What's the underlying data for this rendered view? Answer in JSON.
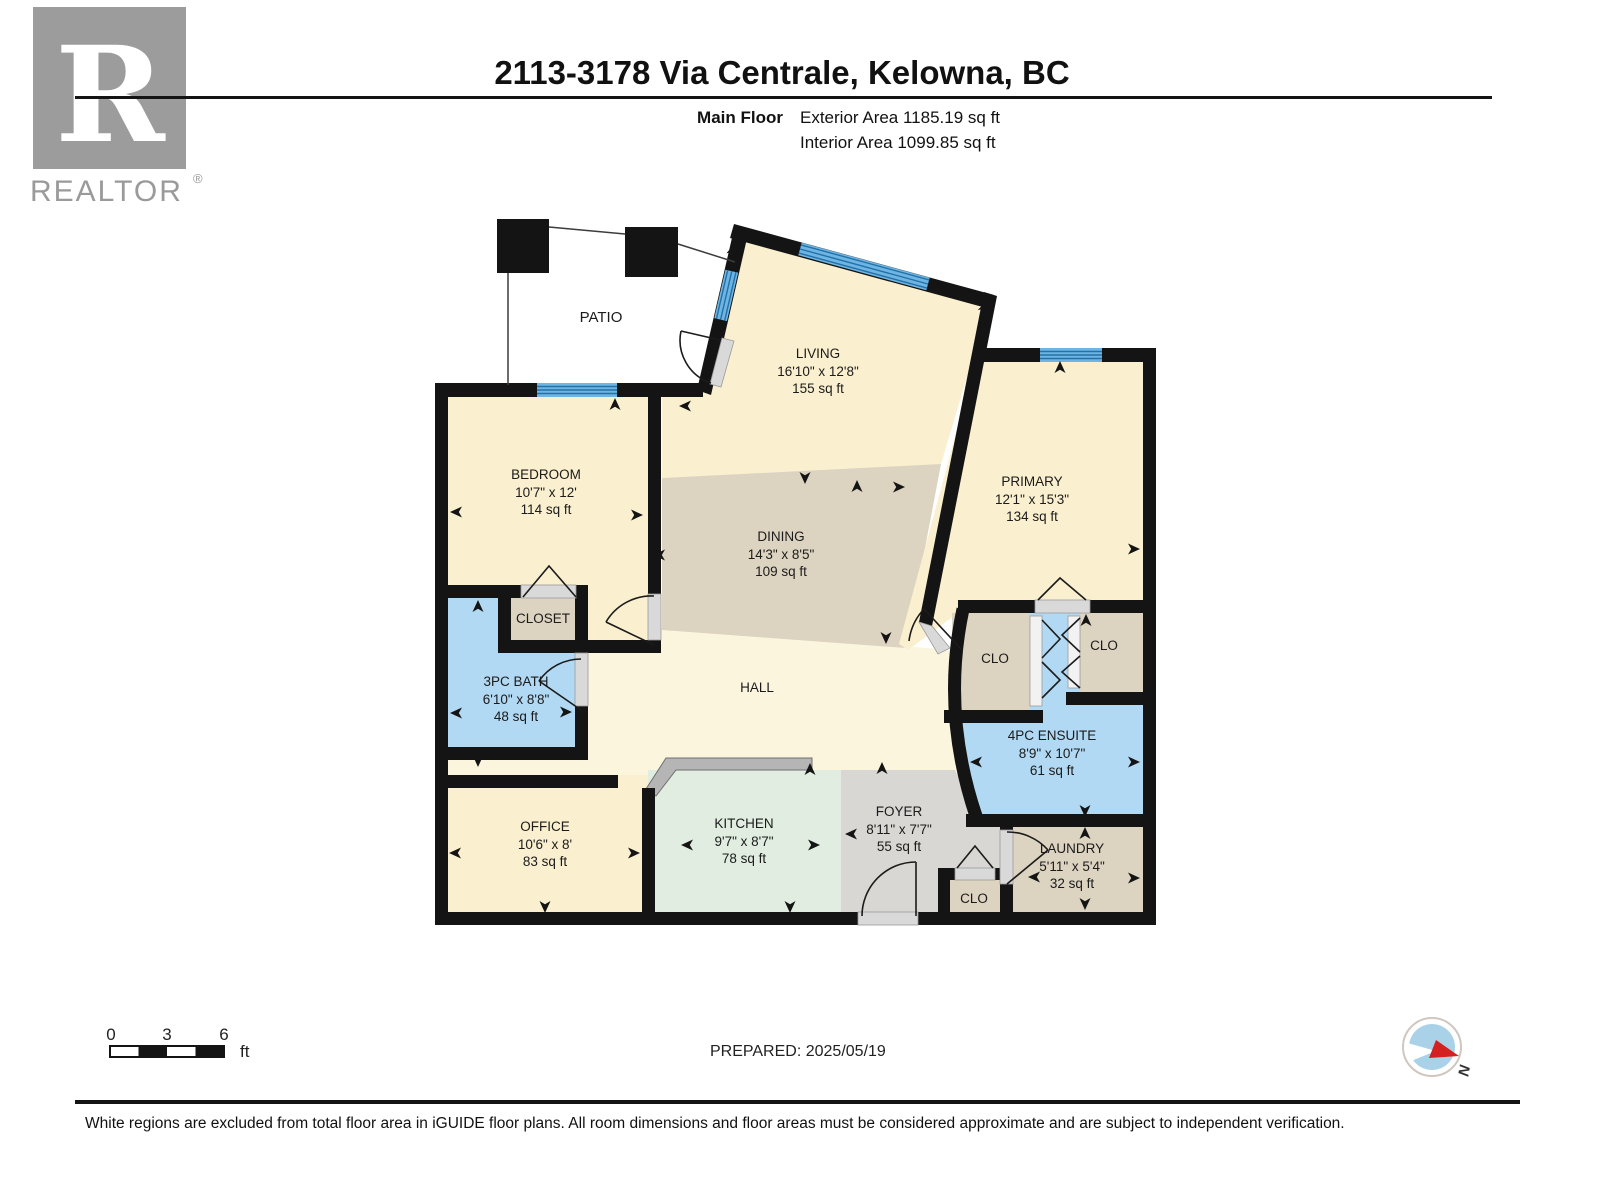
{
  "header": {
    "title": "2113-3178 Via Centrale, Kelowna, BC",
    "floor_label": "Main Floor",
    "exterior_area": "Exterior Area 1185.19 sq ft",
    "interior_area": "Interior Area 1099.85 sq ft"
  },
  "logo": {
    "letter": "R",
    "brand": "REALTOR",
    "registered": "®"
  },
  "rooms": {
    "patio": {
      "name": "PATIO"
    },
    "living": {
      "name": "LIVING",
      "dims": "16'10\" x 12'8\"",
      "area": "155 sq ft"
    },
    "bedroom": {
      "name": "BEDROOM",
      "dims": "10'7\" x 12'",
      "area": "114 sq ft"
    },
    "primary": {
      "name": "PRIMARY",
      "dims": "12'1\" x 15'3\"",
      "area": "134 sq ft"
    },
    "dining": {
      "name": "DINING",
      "dims": "14'3\" x 8'5\"",
      "area": "109 sq ft"
    },
    "closet": {
      "name": "CLOSET"
    },
    "bath": {
      "name": "3PC BATH",
      "dims": "6'10\" x 8'8\"",
      "area": "48 sq ft"
    },
    "hall": {
      "name": "HALL"
    },
    "clo_left": {
      "name": "CLO"
    },
    "clo_right": {
      "name": "CLO"
    },
    "ensuite": {
      "name": "4PC ENSUITE",
      "dims": "8'9\" x 10'7\"",
      "area": "61 sq ft"
    },
    "office": {
      "name": "OFFICE",
      "dims": "10'6\" x 8'",
      "area": "83 sq ft"
    },
    "kitchen": {
      "name": "KITCHEN",
      "dims": "9'7\" x 8'7\"",
      "area": "78 sq ft"
    },
    "foyer": {
      "name": "FOYER",
      "dims": "8'11\" x 7'7\"",
      "area": "55 sq ft"
    },
    "laundry": {
      "name": "LAUNDRY",
      "dims": "5'11\" x 5'4\"",
      "area": "32 sq ft"
    },
    "clo_entry": {
      "name": "CLO"
    }
  },
  "scale_bar": {
    "ticks": [
      "0",
      "3",
      "6"
    ],
    "unit": "ft"
  },
  "prepared": "PREPARED: 2025/05/19",
  "compass": {
    "north_label": "N"
  },
  "footer": "White regions are excluded from total floor area in iGUIDE floor plans. All room dimensions and floor areas must be considered approximate and are subject to independent verification.",
  "colors": {
    "wall": "#141414",
    "room_cream": "#FAEFCE",
    "hall_cream": "#FCF5DE",
    "closet_tan": "#DCD3C1",
    "bath_blue": "#B1D9F3",
    "kitchen_mint": "#E0EDE0",
    "foyer_gray": "#D8D7D4",
    "window_blue": "#6FB5E3",
    "window_stripe": "#2371A8",
    "compass_red": "#D42020",
    "compass_blue": "#A9D2E8",
    "logo_gray": "#9C9C9C"
  }
}
